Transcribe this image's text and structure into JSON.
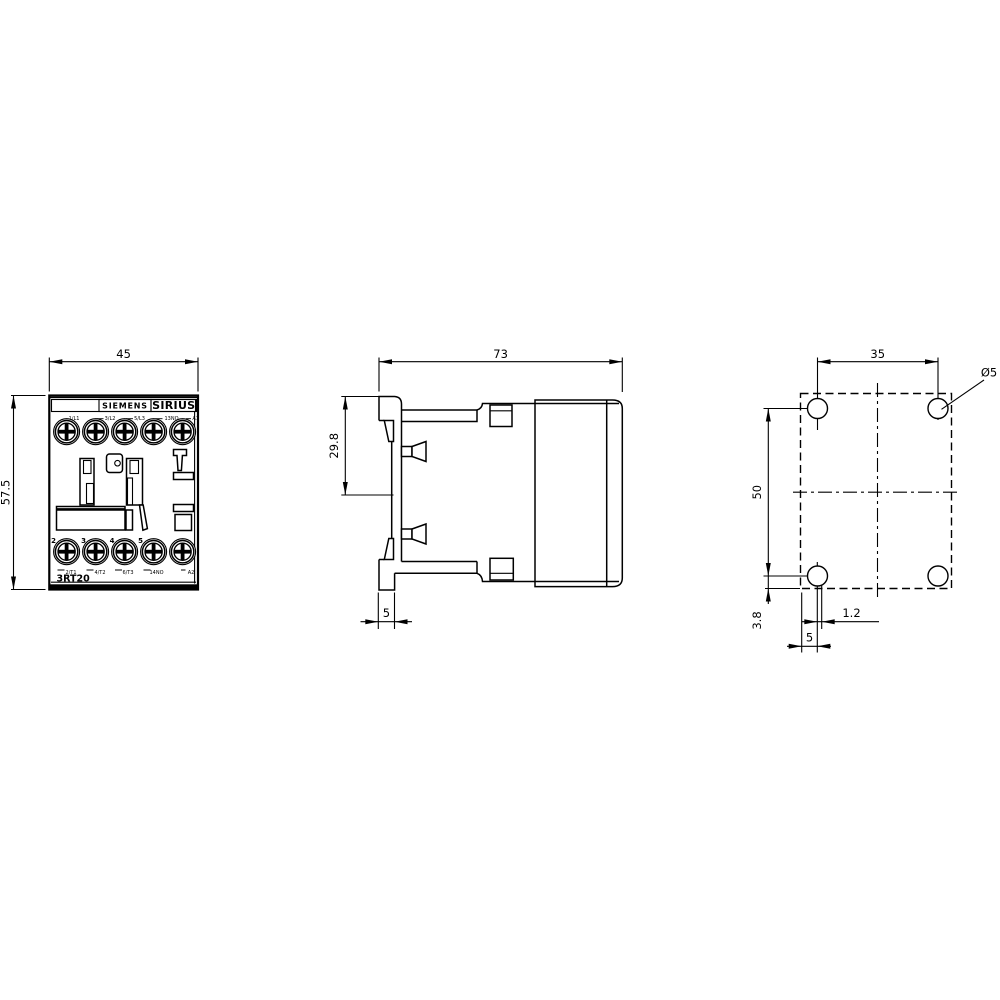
{
  "front": {
    "width_mm": "45",
    "height_mm": "57.5",
    "brand": "SIEMENS",
    "product_line": "SIRIUS",
    "model": "3RT20",
    "top_terminals": [
      "1/L1",
      "3/L2",
      "5/L3",
      "13NO",
      "A1"
    ],
    "bottom_terminals": [
      "2/T1",
      "4/T2",
      "6/T3",
      "14NO",
      "A2"
    ],
    "pole_numbers": [
      "2",
      "3",
      "4",
      "5"
    ]
  },
  "side": {
    "depth_mm": "73",
    "clip_height_mm": "29.8",
    "rail_depth_mm": "5"
  },
  "drill": {
    "horizontal_spacing_mm": "35",
    "vertical_spacing_mm": "50",
    "bottom_offset_mm": "3.8",
    "slot_offset_mm": "1.2",
    "side_offset_mm": "5",
    "hole_diameter": "Ø5"
  }
}
